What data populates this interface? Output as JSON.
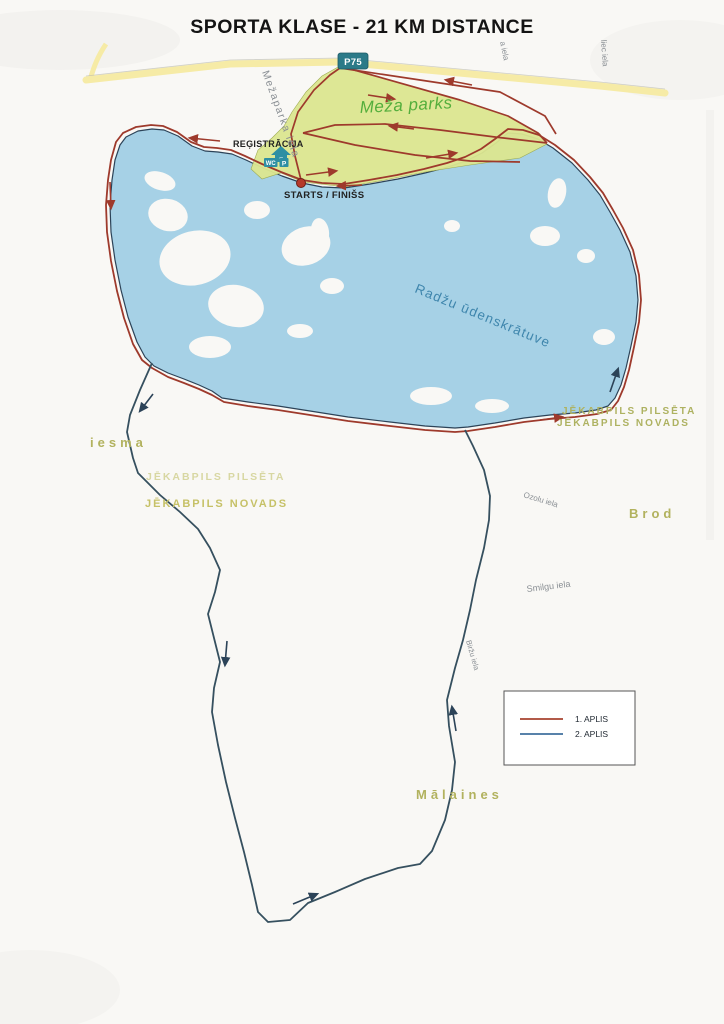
{
  "title": "SPORTA KLASE - 21 KM DISTANCE",
  "map": {
    "road_badge": "P75",
    "park_label": "Meža parks",
    "lake_label": "Radžu ūdenskrātuve",
    "registration_label": "REĢISTRĀCIJA",
    "wc_icon_label": "WC",
    "parking_icon_label": "P",
    "start_finish_label": "STARTS / FINIŠS",
    "street_labels": {
      "mezaparka": "Mežaparka iela",
      "top_right_1": "a iela",
      "top_right_2": "liec iela",
      "ozolu": "Ozolu iela",
      "smilgu": "Smilgu iela",
      "birzu": "Biržu iela"
    },
    "area_labels": {
      "iesma": "iesma",
      "pilseta_left": "JĒKABPILS PILSĒTA",
      "novads_left": "JĒKABPILS NOVADS",
      "pilseta_right": "JĒKABPILS PILSĒTA",
      "novads_right": "JĒKABPILS NOVADS",
      "brod": "Brod",
      "malaines": "Mālaines"
    }
  },
  "legend": {
    "items": [
      {
        "label": "1. APLIS",
        "color": "#a7432f"
      },
      {
        "label": "2. APLIS",
        "color": "#41709e"
      }
    ]
  },
  "colors": {
    "lake": "#a6d1e6",
    "park": "#dce790",
    "road": "#f6eba6",
    "route_lap1": "#9e3a2c",
    "route_lap2": "#2c4358",
    "badge": "#2b7a88",
    "poi_teal": "#2e8fa3"
  }
}
